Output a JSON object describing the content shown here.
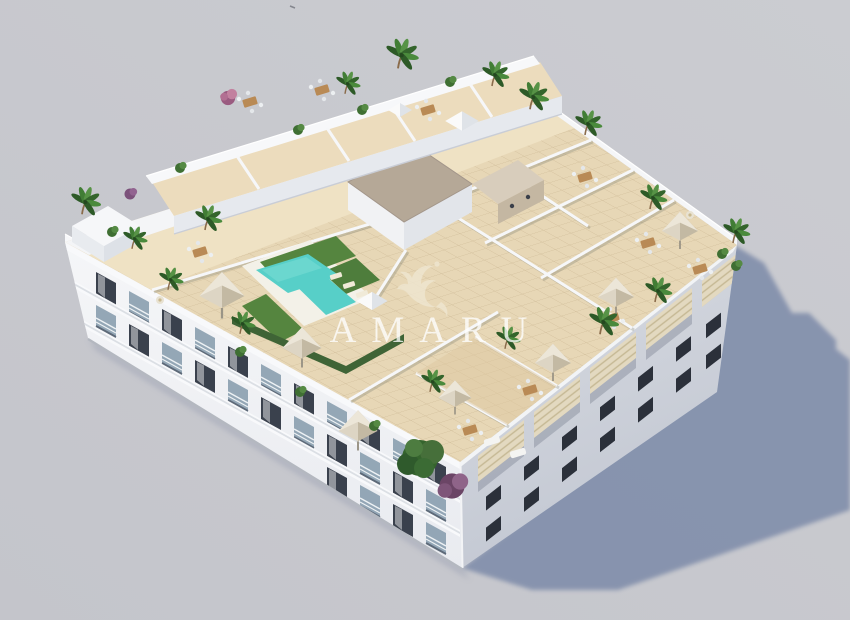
{
  "scene": {
    "description": "Aerial 3D architectural rendering of a white residential apartment block with rooftop terraces, plunge pool, parasols and landscaped planting, casting a shadow to the lower right on a plain grey ground",
    "view": "isometric aerial render",
    "background_color": "#c7c8cd",
    "shadow_color": "#8390ac"
  },
  "watermark": {
    "brand": "AMARU",
    "logo": "winged-dragon-logo",
    "text_color": "#ffffff"
  },
  "palette": {
    "roof_tile": "#e7d7b6",
    "walkway_tile": "#efe2c4",
    "pool_water": "#57cfc8",
    "grass": "#55853f",
    "hedge": "#3f6436",
    "facade_white": "#eef0f4",
    "facade_shaded": "#ccd1da",
    "pergola_wood": "#e3d9c0",
    "umbrella_canopy": "#d8d0bf",
    "vegetation_green": "#3c6b33",
    "vegetation_purple": "#7b517a",
    "gravel_roof": "#b5a897"
  }
}
